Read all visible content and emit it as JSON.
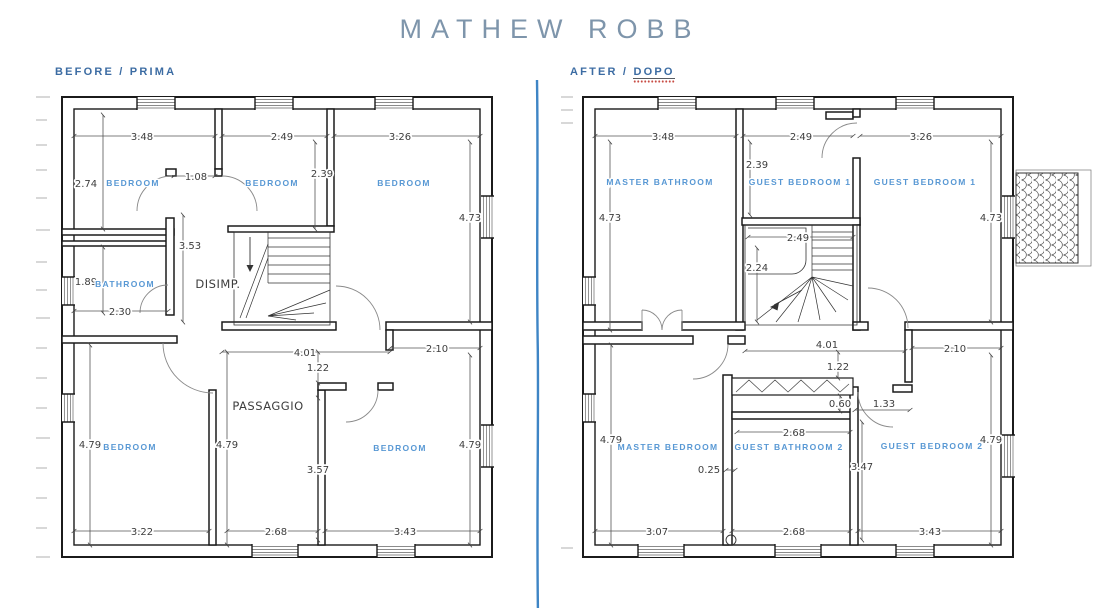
{
  "title": "MATHEW ROBB",
  "colors": {
    "room_label": "#5898d4",
    "dim_text": "#3d3d3d",
    "heading": "#7e95ab",
    "section_label": "#3c6ca3",
    "divider": "#2e7bc0",
    "spellcheck_dots": "#c84c44"
  },
  "panels": {
    "before": {
      "label": "BEFORE / PRIMA",
      "rooms": {
        "tl": "BEDROOM",
        "tm": "BEDROOM",
        "tr": "BEDROOM",
        "bath": "BATHROOM",
        "disimp": "DISIMP.",
        "hall": "PASSAGGIO",
        "bl": "BEDROOM",
        "br": "BEDROOM"
      },
      "dims": {
        "top1": "3.48",
        "top2": "2.49",
        "top3": "3.26",
        "tl_h": "2.74",
        "door": "1.08",
        "tm_h": "2.39",
        "tr_h": "4.73",
        "stair_h": "3.53",
        "bath_h": "1.89",
        "bath_w": "2.30",
        "hall_w": "4.01",
        "hall_r": "2.10",
        "hall_h": "1.22",
        "bl_h": "4.79",
        "bl_h2": "4.79",
        "br_h": "4.79",
        "mid_h": "3.57",
        "bot1": "3.22",
        "bot2": "2.68",
        "bot3": "3.43"
      }
    },
    "after": {
      "label_prefix": "AFTER / ",
      "label_word": "DOPO",
      "rooms": {
        "tl": "MASTER BATHROOM",
        "tm": "GUEST BEDROOM 1",
        "tr": "GUEST BEDROOM 1",
        "bl": "MASTER BEDROOM",
        "bm": "GUEST BATHROOM 2",
        "br": "GUEST BEDROOM 2"
      },
      "dims": {
        "top1": "3.48",
        "top2": "2.49",
        "top3": "3.26",
        "tl_h": "4.73",
        "tm_h": "2.39",
        "tr_h": "4.73",
        "stair_w": "2.49",
        "stair_h": "2.24",
        "hall_w": "4.01",
        "hall_r": "2.10",
        "hall_h": "1.22",
        "shelf": "0.60",
        "niche": "1.33",
        "bath_w": "2.68",
        "off": "0.25",
        "bm_h": "3.47",
        "bl_h": "4.79",
        "br_h": "4.79",
        "bot1": "3.07",
        "bot2": "2.68",
        "bot3": "3.43"
      }
    }
  }
}
